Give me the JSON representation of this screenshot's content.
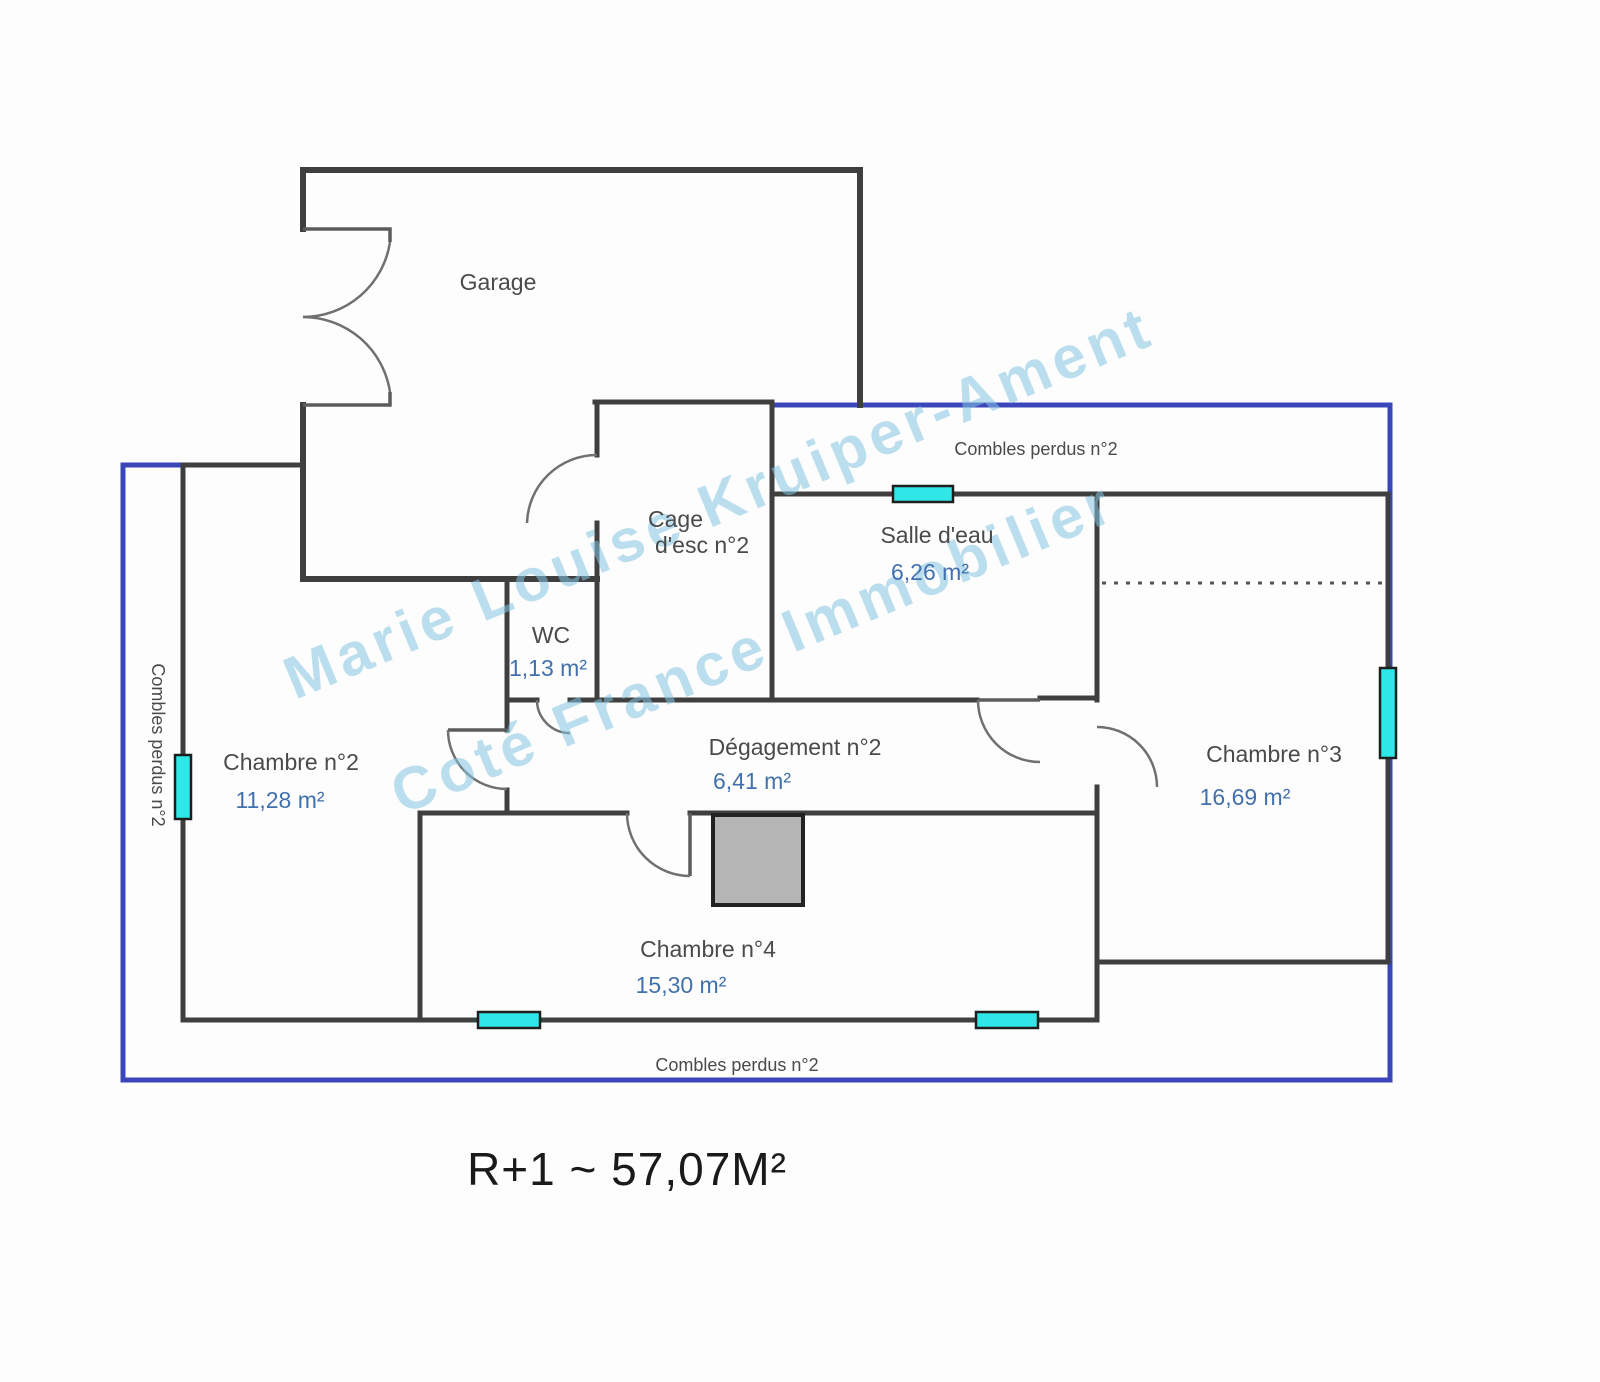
{
  "colors": {
    "wall": "#3f3f3f",
    "boundary": "#3a46ba",
    "window": "#2fe7e7",
    "room-name": "#4a4a4a",
    "room-area": "#4270ad",
    "title": "#1a1a1a",
    "watermark": "rgba(132,196,224,0.55)",
    "chimney": "#b5b5b5"
  },
  "title": "R+1 ~ 57,07M²",
  "watermark": {
    "line1": "Marie Louise Kruiper-Ament",
    "line2": "Coté France Immobilier"
  },
  "rooms": {
    "garage": {
      "name": "Garage"
    },
    "cage": {
      "name_line1": "Cage",
      "name_line2": "d'esc n°2"
    },
    "salle_eau": {
      "name": "Salle d'eau",
      "area": "6,26 m²"
    },
    "wc": {
      "name": "WC",
      "area": "1,13 m²"
    },
    "chambre2": {
      "name": "Chambre n°2",
      "area": "11,28 m²"
    },
    "degagement": {
      "name": "Dégagement n°2",
      "area": "6,41 m²"
    },
    "chambre3": {
      "name": "Chambre n°3",
      "area": "16,69 m²"
    },
    "chambre4": {
      "name": "Chambre n°4",
      "area": "15,30 m²"
    }
  },
  "annotations": {
    "combles_top": "Combles perdus n°2",
    "combles_bottom": "Combles perdus n°2",
    "combles_left": "Combles perdus n°2"
  }
}
